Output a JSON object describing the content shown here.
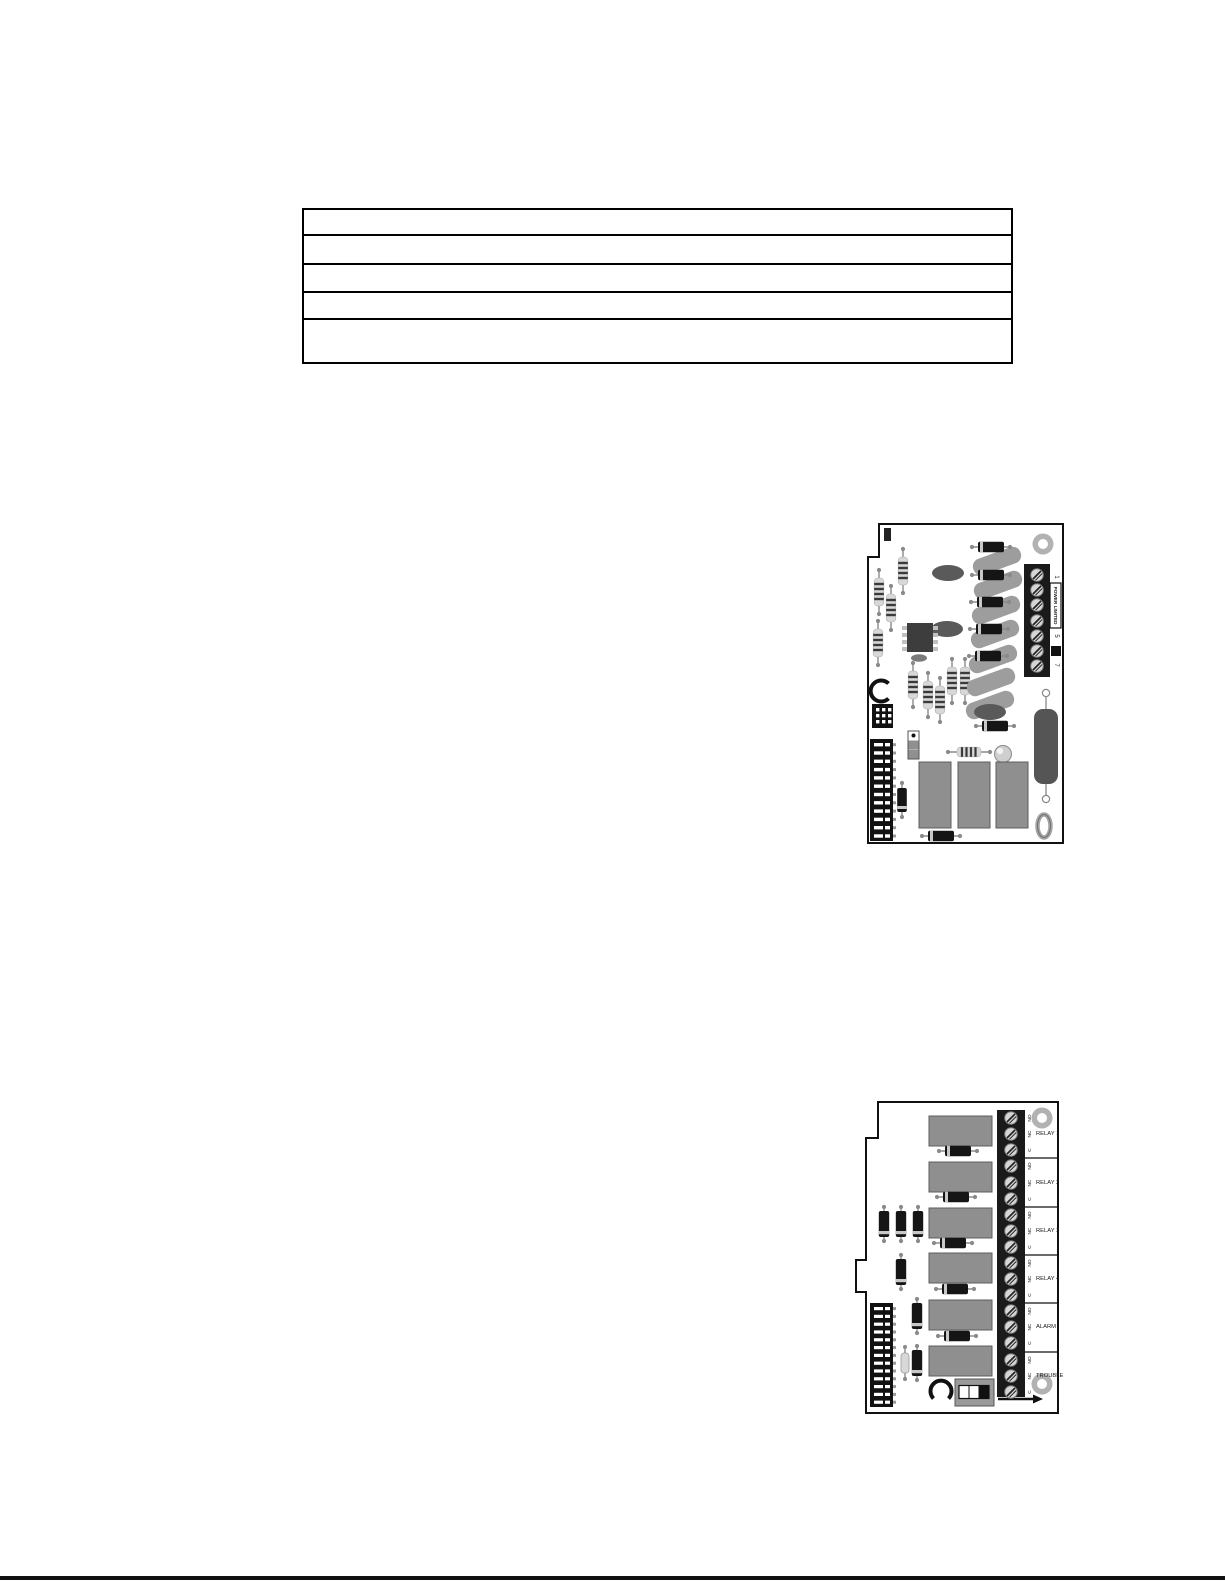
{
  "io_board": {
    "terminal_block": {
      "numbers": [
        "1",
        "5",
        "7"
      ],
      "power_limited_label": "POWER LIMITED",
      "screw_count": 7
    }
  },
  "relay_board": {
    "terminal_labels": {
      "no": "NO",
      "nc": "NC",
      "c": "C"
    },
    "groups": [
      {
        "label": "RELAY 1"
      },
      {
        "label": "RELAY 2"
      },
      {
        "label": "RELAY 3"
      },
      {
        "label": "RELAY 4"
      },
      {
        "label": "ALARM"
      },
      {
        "label": "TROUBLE"
      }
    ],
    "screw_count": 18
  },
  "spec_table": {
    "row_count": 5
  },
  "colors": {
    "outline": "#111111",
    "relay_gray": "#8f8f8f",
    "cap_gray": "#9d9d9d",
    "resistor_body": "#d8d8d8",
    "block_black": "#1a1a1a",
    "hole_ring": "#b2b2b2"
  }
}
